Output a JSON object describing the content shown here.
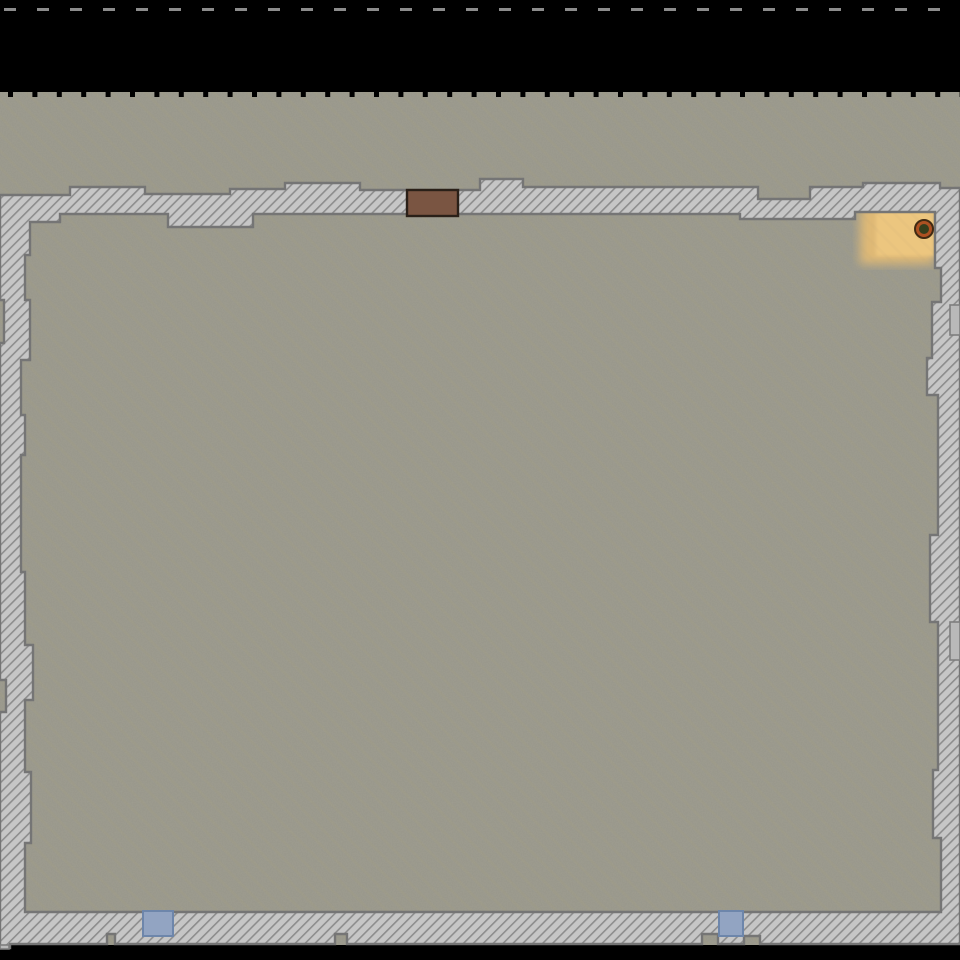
{
  "scene": {
    "canvas": {
      "width": 960,
      "height": 960,
      "background": "#000000"
    },
    "colors": {
      "floor_base": "#97968a",
      "floor_streak": "rgba(168,152,118,0.13)",
      "grain_tint": "0 0 0 0 0.62  0 0 0 0 0.58  0 0 0 0 0.47  0 0 0 0.16 0",
      "wall_fill": "#c6c6c6",
      "wall_hatch": "#8d8d8d",
      "wall_border": "#757575",
      "door_fill": "#7a5542",
      "door_border": "#2a2018",
      "window_fill": "#92a4c2",
      "window_border": "#6d86ab",
      "sand_outer": "#e3bb74",
      "sand_core": "#ecc67f",
      "entity_ring": "#ad5122",
      "entity_ring_border": "#402a12",
      "entity_core": "#363e1c",
      "notch_fill": "#b9b9b9",
      "notch_border": "#7e7e7e",
      "tick_black": "#000000",
      "tick_gray": "#8c8c8c"
    },
    "floor": {
      "x": 0,
      "y": 92,
      "w": 960,
      "h": 853
    },
    "top_void_dashes": {
      "y": 8,
      "h": 3,
      "w": 12,
      "spacing": 33,
      "offset": 4,
      "count": 30
    },
    "floor_edge_ticks": {
      "y": 92,
      "h": 5,
      "w": 5,
      "spacing": 24.4,
      "offset": 8,
      "count": 40
    },
    "wall_ring": {
      "outer": [
        [
          0,
          195
        ],
        [
          70,
          195
        ],
        [
          70,
          187
        ],
        [
          145,
          187
        ],
        [
          145,
          194
        ],
        [
          230,
          194
        ],
        [
          230,
          189
        ],
        [
          285,
          189
        ],
        [
          285,
          183
        ],
        [
          360,
          183
        ],
        [
          360,
          190
        ],
        [
          480,
          190
        ],
        [
          480,
          179
        ],
        [
          523,
          179
        ],
        [
          523,
          187
        ],
        [
          758,
          187
        ],
        [
          758,
          199
        ],
        [
          810,
          199
        ],
        [
          810,
          187
        ],
        [
          863,
          187
        ],
        [
          863,
          183
        ],
        [
          940,
          183
        ],
        [
          940,
          188
        ],
        [
          960,
          188
        ],
        [
          960,
          944
        ],
        [
          760,
          944
        ],
        [
          760,
          936
        ],
        [
          744,
          936
        ],
        [
          744,
          944
        ],
        [
          718,
          944
        ],
        [
          718,
          934
        ],
        [
          702,
          934
        ],
        [
          702,
          944
        ],
        [
          347,
          944
        ],
        [
          347,
          934
        ],
        [
          335,
          934
        ],
        [
          335,
          944
        ],
        [
          115,
          944
        ],
        [
          115,
          934
        ],
        [
          107,
          934
        ],
        [
          107,
          944
        ],
        [
          10,
          944
        ],
        [
          10,
          948
        ],
        [
          0,
          948
        ],
        [
          0,
          712
        ],
        [
          6,
          712
        ],
        [
          6,
          680
        ],
        [
          0,
          680
        ],
        [
          0,
          343
        ],
        [
          4,
          343
        ],
        [
          4,
          300
        ],
        [
          0,
          300
        ]
      ],
      "inner": [
        [
          30,
          222
        ],
        [
          60,
          222
        ],
        [
          60,
          214
        ],
        [
          168,
          214
        ],
        [
          168,
          227
        ],
        [
          253,
          227
        ],
        [
          253,
          214
        ],
        [
          740,
          214
        ],
        [
          740,
          219
        ],
        [
          855,
          219
        ],
        [
          855,
          212
        ],
        [
          935,
          212
        ],
        [
          935,
          268
        ],
        [
          941,
          268
        ],
        [
          941,
          302
        ],
        [
          932,
          302
        ],
        [
          932,
          358
        ],
        [
          927,
          358
        ],
        [
          927,
          395
        ],
        [
          938,
          395
        ],
        [
          938,
          535
        ],
        [
          930,
          535
        ],
        [
          930,
          622
        ],
        [
          938,
          622
        ],
        [
          938,
          770
        ],
        [
          933,
          770
        ],
        [
          933,
          838
        ],
        [
          941,
          838
        ],
        [
          941,
          912
        ],
        [
          25,
          912
        ],
        [
          25,
          843
        ],
        [
          31,
          843
        ],
        [
          31,
          772
        ],
        [
          25,
          772
        ],
        [
          25,
          700
        ],
        [
          33,
          700
        ],
        [
          33,
          645
        ],
        [
          25,
          645
        ],
        [
          25,
          572
        ],
        [
          21,
          572
        ],
        [
          21,
          455
        ],
        [
          25,
          455
        ],
        [
          25,
          415
        ],
        [
          21,
          415
        ],
        [
          21,
          360
        ],
        [
          30,
          360
        ],
        [
          30,
          300
        ],
        [
          25,
          300
        ],
        [
          25,
          255
        ],
        [
          30,
          255
        ]
      ]
    },
    "hatch": {
      "period": 7,
      "thickness": 1.6,
      "angle": 45
    },
    "streaks": {
      "period": 12,
      "thickness": 3,
      "angle": -45
    },
    "sand_patch": {
      "outer": {
        "x": 860,
        "y": 206,
        "w": 74,
        "h": 58,
        "blur": 5
      },
      "core": {
        "x": 876,
        "y": 210,
        "w": 58,
        "h": 46,
        "blur": 1.5
      }
    },
    "door": {
      "x": 407,
      "y": 190,
      "w": 51,
      "h": 26
    },
    "windows": [
      {
        "x": 143,
        "y": 911,
        "w": 30,
        "h": 25
      },
      {
        "x": 719,
        "y": 911,
        "w": 24,
        "h": 25
      }
    ],
    "entity": {
      "cx": 924,
      "cy": 229,
      "r": 9,
      "core_r": 5
    },
    "right_edge_notches": [
      {
        "x": 950,
        "y": 305,
        "w": 10,
        "h": 30
      },
      {
        "x": 950,
        "y": 622,
        "w": 10,
        "h": 38
      },
      {
        "x": 0,
        "y": 945,
        "w": 9,
        "h": 4
      }
    ]
  }
}
